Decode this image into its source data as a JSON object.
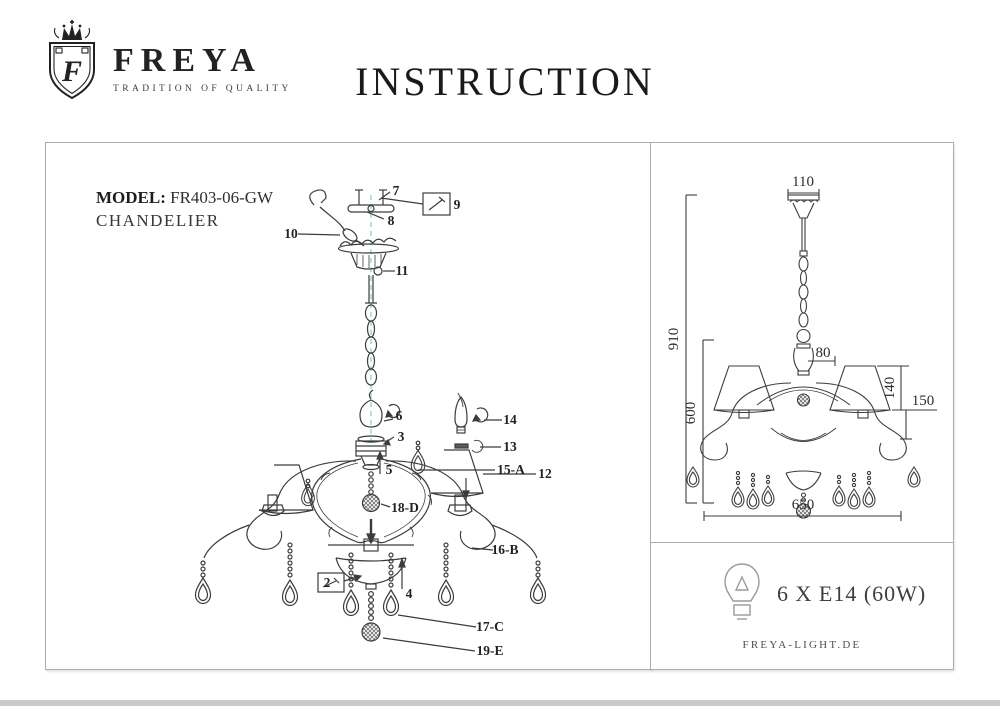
{
  "header": {
    "brand": "FREYA",
    "tagline": "TRADITION OF QUALITY",
    "logo_letter": "F",
    "title": "INSTRUCTION"
  },
  "left_panel": {
    "model_label": "MODEL:",
    "model_value": "FR403-06-GW",
    "product_type": "CHANDELIER",
    "callouts": {
      "c7": "7",
      "c9": "9",
      "c8": "8",
      "c10": "10",
      "c11": "11",
      "c6": "6",
      "c3": "3",
      "c14": "14",
      "c13": "13",
      "c15a": "15-A",
      "c12": "12",
      "c5": "5",
      "c18d": "18-D",
      "c16b": "16-B",
      "c2": "2",
      "c4": "4",
      "c17c": "17-C",
      "c19e": "19-E"
    }
  },
  "right_panel": {
    "dimensions": {
      "canopy_width": "110",
      "total_height": "910",
      "top_ornament_height": "80",
      "shade_height": "140",
      "shade_total_height": "150",
      "body_height": "600",
      "diameter": "650"
    },
    "bulb_spec": "6 X E14 (60W)",
    "website": "FREYA-LIGHT.DE"
  }
}
